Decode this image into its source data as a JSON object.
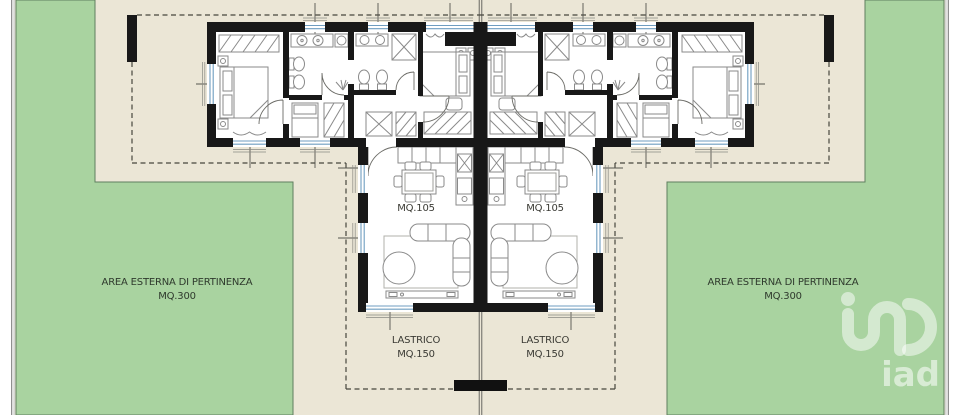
{
  "colors": {
    "canvas": "#ffffff",
    "paper_beige": "#ebe6d6",
    "garden_green": "#a9d3a0",
    "garden_border": "#5f7f5f",
    "wall_black": "#181818",
    "window_blue": "#6f9dc0",
    "furniture_gray": "#8a8a8a",
    "boundary_dash": "#46463e",
    "watermark_white": "#ffffff"
  },
  "garden_left": {
    "line1": "AREA ESTERNA DI PERTINENZA",
    "line2": "MQ.300"
  },
  "garden_right": {
    "line1": "AREA ESTERNA DI PERTINENZA",
    "line2": "MQ.300"
  },
  "unit_left": {
    "area_label": "MQ.105"
  },
  "unit_right": {
    "area_label": "MQ.105"
  },
  "terrace_left": {
    "line1": "LASTRICO",
    "line2": "MQ.150"
  },
  "terrace_right": {
    "line1": "LASTRICO",
    "line2": "MQ.150"
  },
  "watermark": {
    "brand": "iad"
  },
  "icons": [
    "iad-logo",
    "double-bed-icon",
    "single-bed-icon",
    "wardrobe-icon",
    "dining-table-icon",
    "corner-sofa-icon",
    "ottoman-icon",
    "rug-icon",
    "kitchen-counter-icon",
    "stove-icon",
    "shower-icon",
    "toilet-icon",
    "bidet-icon",
    "washbasin-icon",
    "washing-machine-icon",
    "door-swing-icon",
    "window-icon",
    "plant-icon",
    "boundary-pillar-icon",
    "tv-cabinet-icon"
  ]
}
